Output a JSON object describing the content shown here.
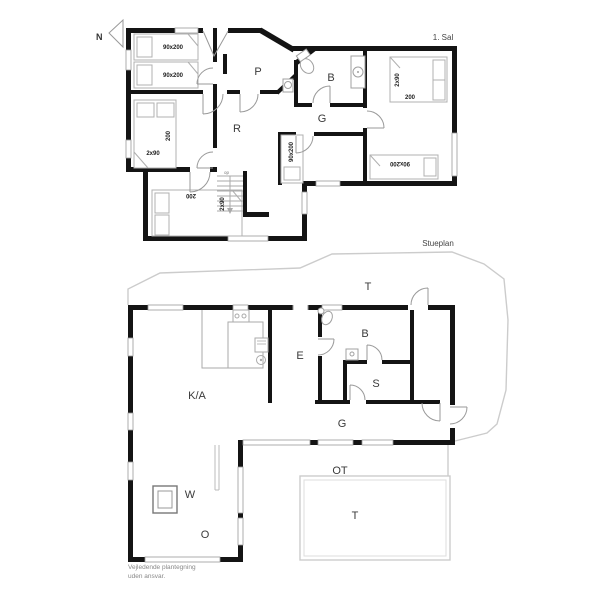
{
  "colors": {
    "wall": "#141414",
    "fixture_outline": "#b0b0b0",
    "door_arc": "#999999",
    "terrace_outline": "#cccccc",
    "label_text": "#3a3a3a",
    "dimension_text": "#222222",
    "footer_text": "#888888"
  },
  "upper_plan": {
    "title": "1. Sal",
    "north_label": "N",
    "stairs_label": "op",
    "rooms": {
      "p": "P",
      "b": "B",
      "g": "G",
      "r": "R"
    },
    "beds": {
      "top_bed_1": "90x200",
      "top_bed_2": "90x200",
      "west_double_width": "2x90",
      "west_double_length": "200",
      "middle_single": "90x200",
      "east_double_width": "2x90",
      "east_double_length": "200",
      "east_single": "90x200",
      "south_double_length": "200",
      "south_double_width": "2x90"
    }
  },
  "lower_plan": {
    "title": "Stueplan",
    "rooms": {
      "terrace_top": "T",
      "bath": "B",
      "entry": "E",
      "bedroom": "S",
      "kitchen_living": "K/A",
      "hall": "G",
      "room_w": "W",
      "room_o": "O",
      "covered_terrace": "OT",
      "terrace_bottom": "T"
    }
  },
  "footer": {
    "line1": "Vejledende plantegning",
    "line2": "uden ansvar."
  }
}
